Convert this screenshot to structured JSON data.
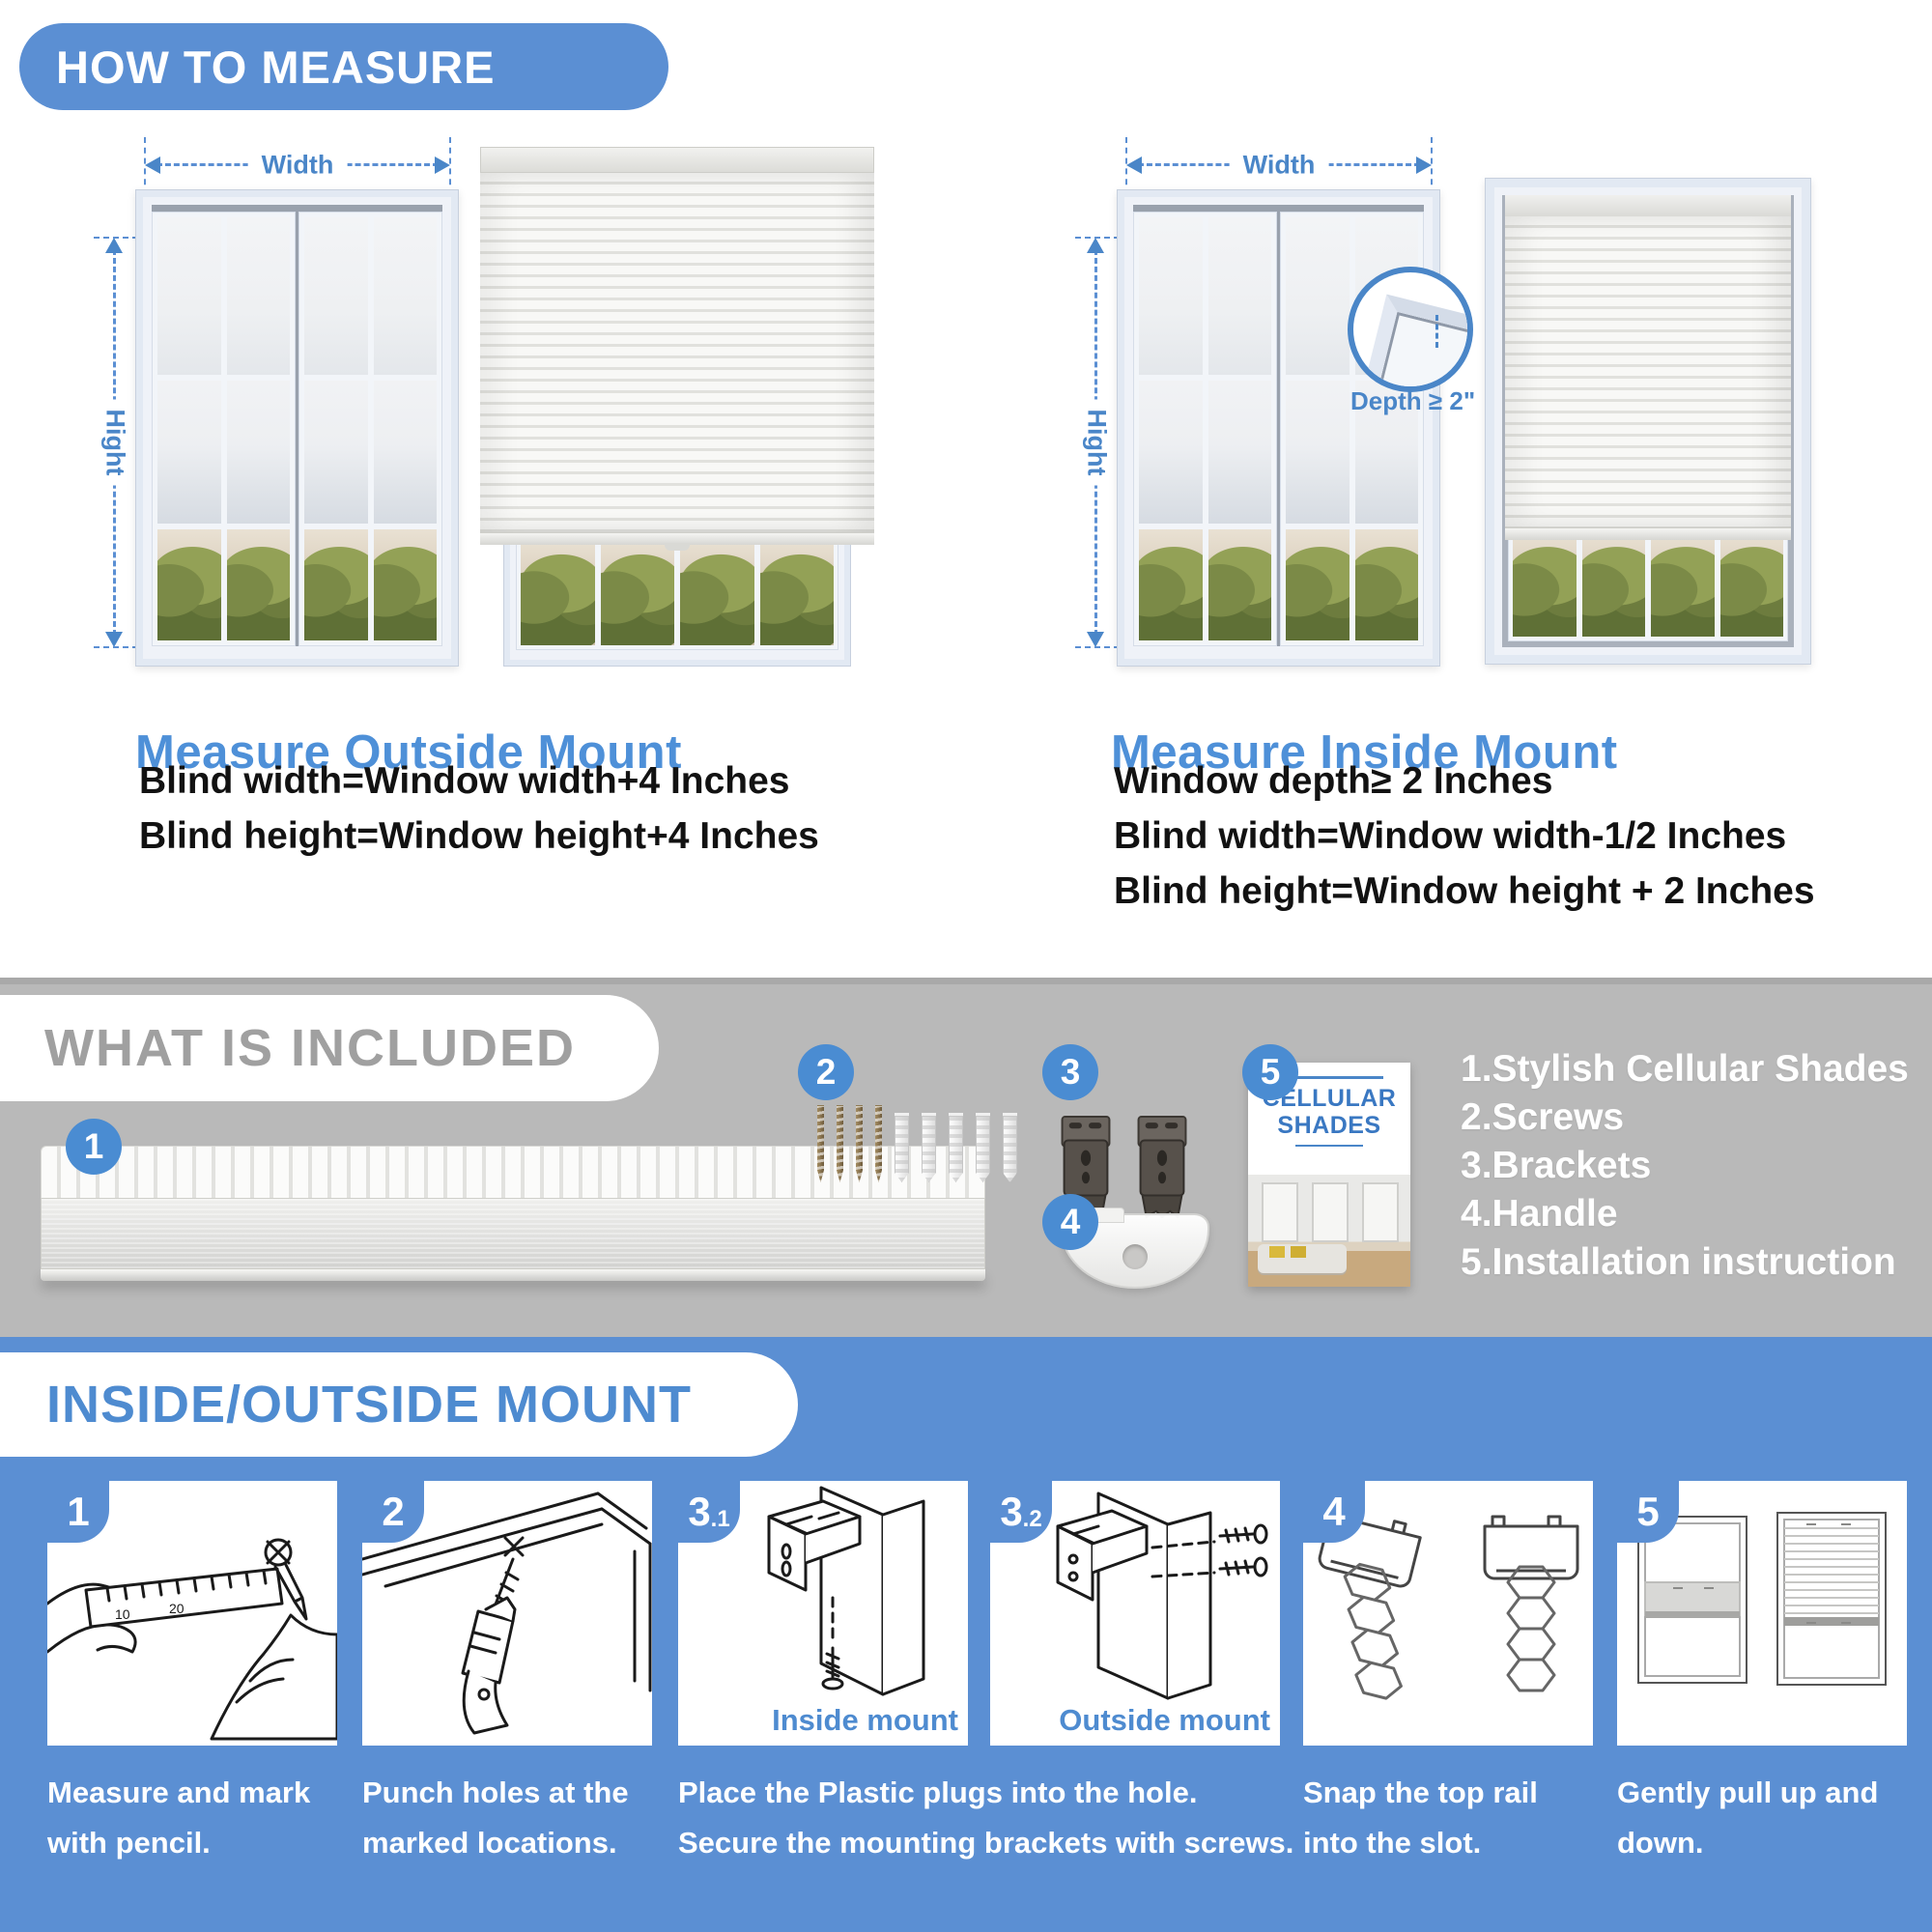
{
  "colors": {
    "primary_blue": "#5b8fd3",
    "accent_blue": "#4a86c8",
    "heading_blue": "#4e90d8",
    "gray_section": "#b9b9b9",
    "gray_heading_text": "#a0a0a0",
    "body_text": "#121212",
    "white": "#ffffff"
  },
  "measure": {
    "header": "HOW TO MEASURE",
    "width_label": "Width",
    "height_label": "Hight",
    "outside": {
      "title": "Measure Outside Mount",
      "lines": [
        "Blind width=Window width+4 Inches",
        "Blind height=Window height+4 Inches"
      ]
    },
    "inside": {
      "title": "Measure Inside Mount",
      "depth_label": "Depth ≥ 2\"",
      "lines": [
        "Window depth≥ 2 Inches",
        "Blind width=Window width-1/2 Inches",
        "Blind height=Window height + 2 Inches"
      ]
    }
  },
  "included": {
    "header": "WHAT IS INCLUDED",
    "badges": {
      "b1": "1",
      "b2": "2",
      "b3": "3",
      "b4": "4",
      "b5": "5"
    },
    "booklet": {
      "line1": "CELLULAR",
      "line2": "SHADES"
    },
    "items": [
      "1.Stylish Cellular Shades",
      "2.Screws",
      "3.Brackets",
      "4.Handle",
      "5.Installation instruction"
    ]
  },
  "mount": {
    "header": "INSIDE/OUTSIDE MOUNT",
    "ruler_marks": [
      "10",
      "20"
    ],
    "steps": [
      {
        "num": "1",
        "caption": [
          "Measure and mark",
          "with pencil."
        ]
      },
      {
        "num": "2",
        "caption": [
          "Punch holes at the",
          "marked locations."
        ]
      },
      {
        "num": "3",
        "sub": ".1",
        "label": "Inside mount"
      },
      {
        "num": "3",
        "sub": ".2",
        "label": "Outside mount"
      },
      {
        "num": "4",
        "caption": [
          "Snap the top rail",
          "into the slot."
        ]
      },
      {
        "num": "5",
        "caption": [
          "Gently pull up and",
          "down."
        ]
      }
    ],
    "caption3": [
      "Place the Plastic plugs into the hole.",
      "Secure the mounting brackets with screws."
    ]
  }
}
